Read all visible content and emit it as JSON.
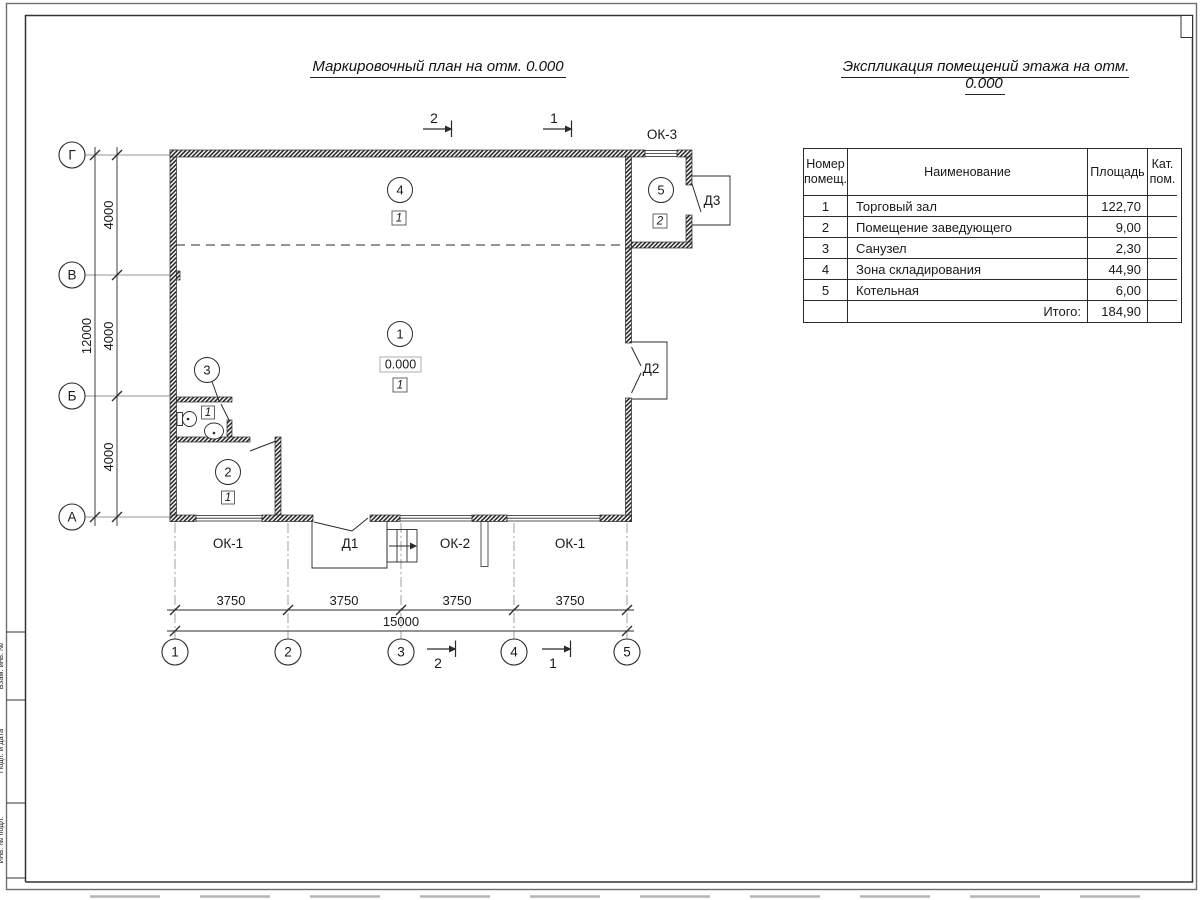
{
  "titles": {
    "plan": "Маркировочный план на отм. 0.000",
    "schedule": "Экспликация помещений этажа на отм. 0.000"
  },
  "schedule_table": {
    "headers": {
      "num": "Номер помещ.",
      "name": "Наименование",
      "area": "Площадь",
      "cat": "Кат. пом."
    },
    "rows": [
      {
        "num": "1",
        "name": "Торговый зал",
        "area": "122,70"
      },
      {
        "num": "2",
        "name": "Помещение заведующего",
        "area": "9,00"
      },
      {
        "num": "3",
        "name": "Санузел",
        "area": "2,30"
      },
      {
        "num": "4",
        "name": "Зона складирования",
        "area": "44,90"
      },
      {
        "num": "5",
        "name": "Котельная",
        "area": "6,00"
      }
    ],
    "total_label": "Итого:",
    "total_area": "184,90"
  },
  "plan": {
    "axes_rows": [
      "Г",
      "В",
      "Б",
      "А"
    ],
    "axes_cols": [
      "1",
      "2",
      "3",
      "4",
      "5"
    ],
    "dims": {
      "left_total": "12000",
      "left_seg": "4000",
      "bottom_seg": "3750",
      "bottom_total": "15000"
    },
    "rooms": {
      "r1": {
        "num": "1",
        "cat": "1",
        "elevation": "0.000"
      },
      "r2": {
        "num": "2",
        "cat": "1"
      },
      "r3": {
        "num": "3",
        "cat": "1"
      },
      "r4": {
        "num": "4",
        "cat": "1"
      },
      "r5": {
        "num": "5",
        "cat": "2"
      }
    },
    "openings": {
      "ok1": "ОК-1",
      "ok2": "ОК-2",
      "ok3": "ОК-3",
      "d1": "Д1",
      "d2": "Д2",
      "d3": "Д3"
    },
    "sections": {
      "s1": "1",
      "s2": "2"
    },
    "line_colors": {
      "walls": "#2b2b2b",
      "axes": "#969696",
      "dims": "#2b2b2b"
    }
  },
  "frame": {
    "side_labels": [
      "Взам. инв. №",
      "Подп. и дата",
      "Инв. № подл."
    ]
  }
}
